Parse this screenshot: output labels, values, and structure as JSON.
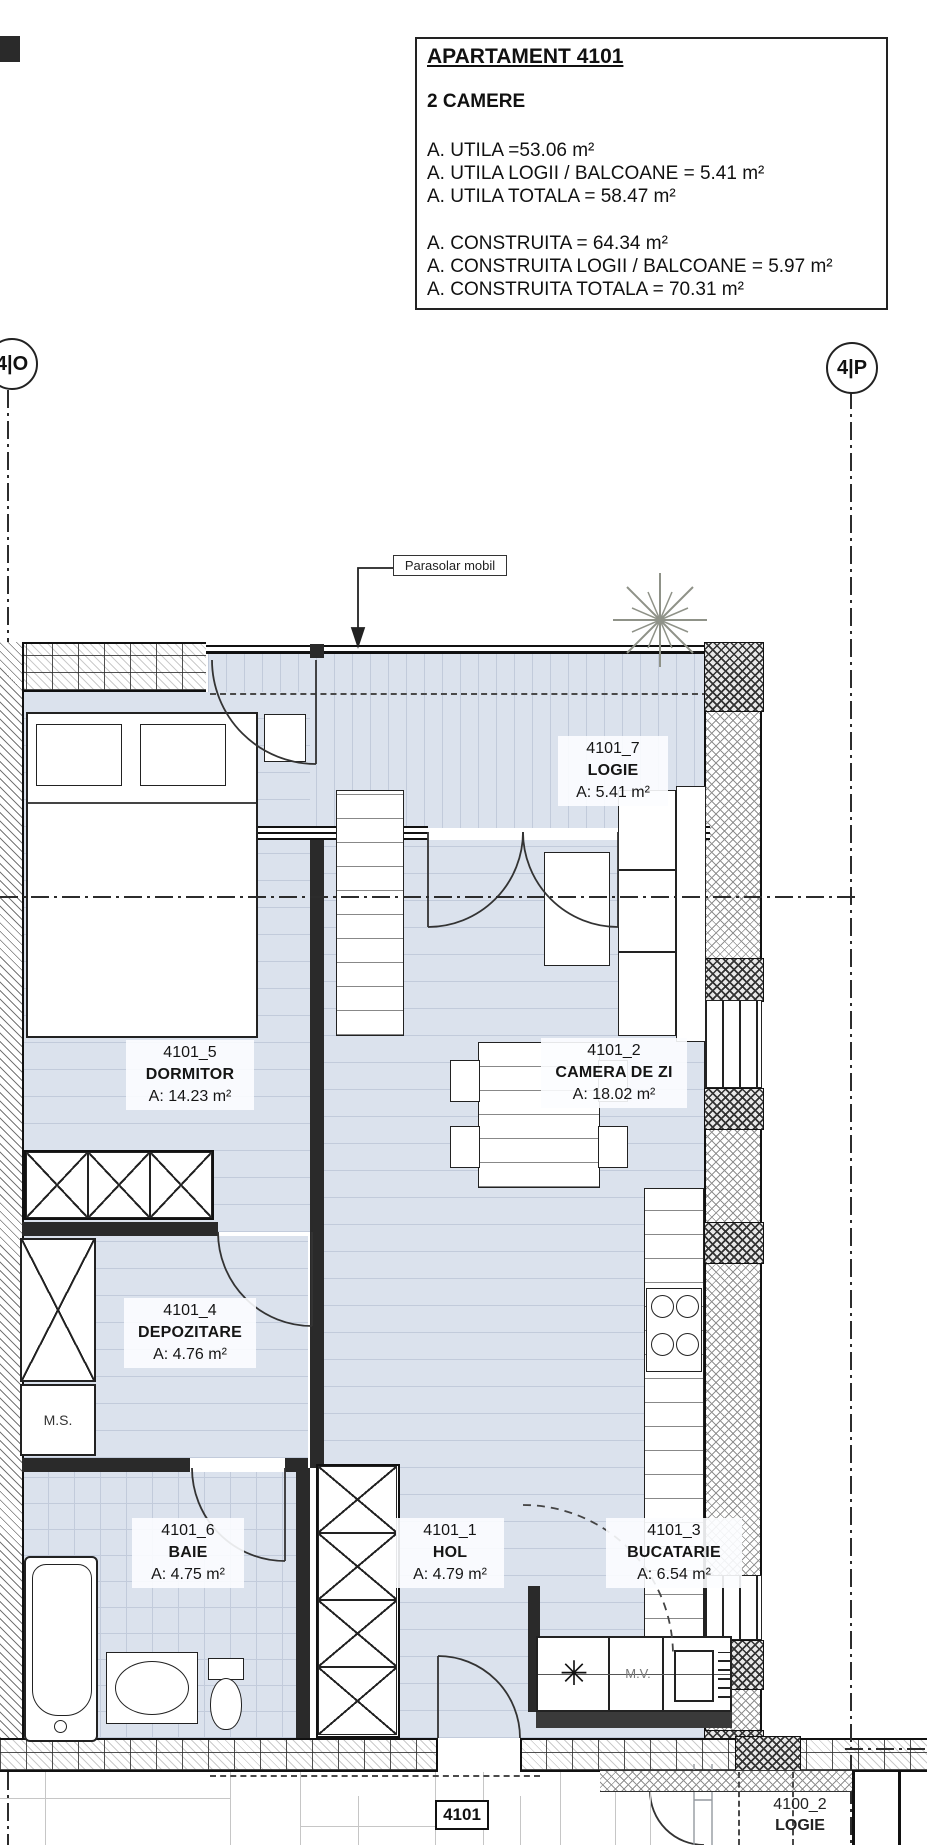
{
  "title_block": {
    "title": "APARTAMENT 4101",
    "type": "2 CAMERE",
    "areas_useful": [
      "A. UTILA =53.06 m²",
      "A. UTILA LOGII / BALCOANE = 5.41 m²",
      "A. UTILA TOTALA = 58.47 m²"
    ],
    "areas_built": [
      "A. CONSTRUITA = 64.34 m²",
      "A. CONSTRUITA LOGII / BALCOANE = 5.97 m²",
      "A. CONSTRUITA TOTALA = 70.31 m²"
    ]
  },
  "axis_markers": {
    "left": "4|O",
    "right": "4|P"
  },
  "annotations": {
    "parasolar": "Parasolar mobil",
    "washing_machine": "M.S.",
    "mv": "M.V.",
    "drain_symbol": "✳",
    "apartment_number": "4101"
  },
  "rooms": [
    {
      "id": "4101_7",
      "name": "LOGIE",
      "area": "A: 5.41 m²"
    },
    {
      "id": "4101_5",
      "name": "DORMITOR",
      "area": "A: 14.23 m²"
    },
    {
      "id": "4101_2",
      "name": "CAMERA DE ZI",
      "area": "A: 18.02 m²"
    },
    {
      "id": "4101_4",
      "name": "DEPOZITARE",
      "area": "A: 4.76 m²"
    },
    {
      "id": "4101_6",
      "name": "BAIE",
      "area": "A: 4.75 m²"
    },
    {
      "id": "4101_1",
      "name": "HOL",
      "area": "A: 4.79 m²"
    },
    {
      "id": "4101_3",
      "name": "BUCATARIE",
      "area": "A: 6.54 m²"
    }
  ],
  "neighbor": {
    "id": "4100_2",
    "name": "LOGIE"
  },
  "colors": {
    "floor": "#dbe2ed",
    "plank_line": "#c2cbdb",
    "wall": "#2a2a2a",
    "linework": "#333333"
  }
}
